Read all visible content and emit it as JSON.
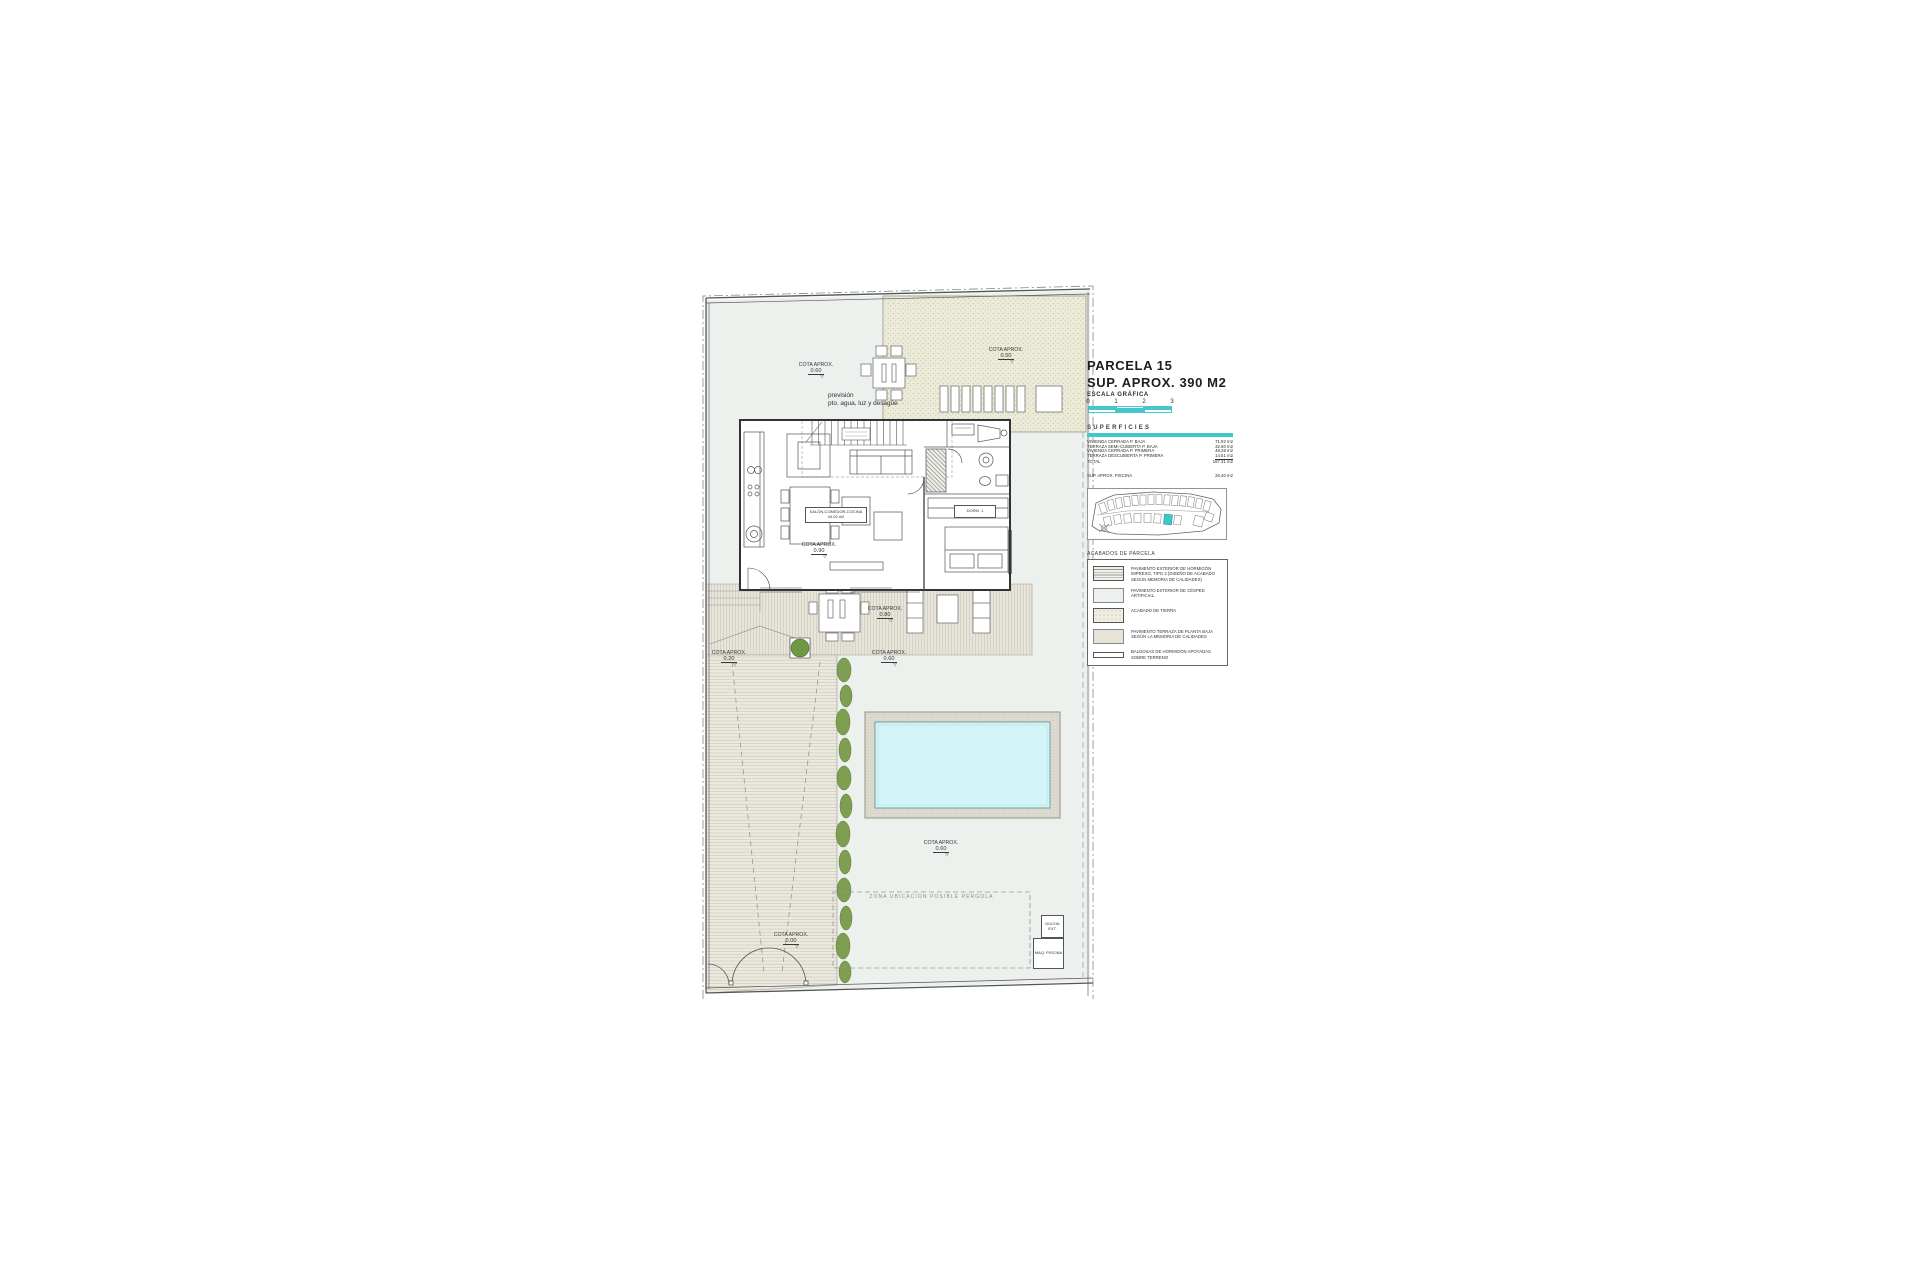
{
  "title_block": {
    "parcel": "PARCELA 15",
    "area": "SUP. APROX. 390 M2",
    "scale_label": "ESCALA GRÁFICA",
    "scale_ticks": [
      "0",
      "1",
      "2",
      "3"
    ]
  },
  "superficies": {
    "title": "SUPERFICIES",
    "rows": [
      {
        "label": "VIVIENDA CERRADA P. BAJA",
        "value": "71.92 m2"
      },
      {
        "label": "TERRAZA SEMI-CUBIERTA P. BAJA",
        "value": "32.60 m2"
      },
      {
        "label": "VIVIENDA CERRADA P. PRIMERA",
        "value": "48.28 m2"
      },
      {
        "label": "TERRAZA DESCUBIERTA P. PRIMERA",
        "value": "14.51 m2"
      },
      {
        "label": "TOTAL",
        "value": "167.31 m2"
      }
    ],
    "pool_row": {
      "label": "SUP. APROX. PISCINA",
      "value": "26.40 m2"
    }
  },
  "site_map": {
    "title": "ESQUEMA DE FASES"
  },
  "legend": {
    "title": "ACABADOS DE PARCELA",
    "items": [
      {
        "swatch": "striped",
        "label": "PAVIMENTO EXTERIOR DE HORMIGÓN IMPRESO, TIPO 2 (DISEÑO DE ACABADO SEGÚN MEMORIA DE CALIDADES)"
      },
      {
        "swatch": "plain",
        "label": "PAVIMENTO EXTERIOR DE CÉSPED ARTIFICIAL"
      },
      {
        "swatch": "speckle",
        "label": "ACABADO DE TIERRA"
      },
      {
        "swatch": "beige",
        "label": "PAVIMENTO TERRAZA DE PLANTA BAJA SEGÚN LA MEMORIA DE CALIDADES"
      },
      {
        "swatch": "thin",
        "label": "BALDOSAS DE HORMIGÓN APOYADAS SOBRE TERRENO"
      }
    ]
  },
  "plan": {
    "prevision_line1": "previsión",
    "prevision_line2": "pto. agua, luz y desagüe",
    "pergola_zone": "ZONA UBICACIÓN POSIBLE PÉRGOLA",
    "ducha": "DUCHA EXT.",
    "maq": "MAQ. PISCINA",
    "room_label": "SALÓN-COMEDOR-COCINA",
    "room_area": "44.02 m2",
    "dorm_label": "DORM. 1",
    "cotas": [
      {
        "label": "COTA APROX.",
        "value": "0.60"
      },
      {
        "label": "COTA APROX.",
        "value": "0.50"
      },
      {
        "label": "COTA APROX.",
        "value": "0.90"
      },
      {
        "label": "COTA APROX.",
        "value": "0.80"
      },
      {
        "label": "COTA APROX.",
        "value": "0.20"
      },
      {
        "label": "COTA APROX.",
        "value": "0.60"
      },
      {
        "label": "COTA APROX.",
        "value": "0.60"
      },
      {
        "label": "COTA APROX.",
        "value": "0.00"
      }
    ]
  },
  "colors": {
    "accent": "#45c6cb",
    "water": "#d3f5f8",
    "lawn": "#ecf1ee",
    "tierra": "#ecebd9",
    "terrace": "#e7e4da",
    "hedge": "#7e9e52"
  }
}
